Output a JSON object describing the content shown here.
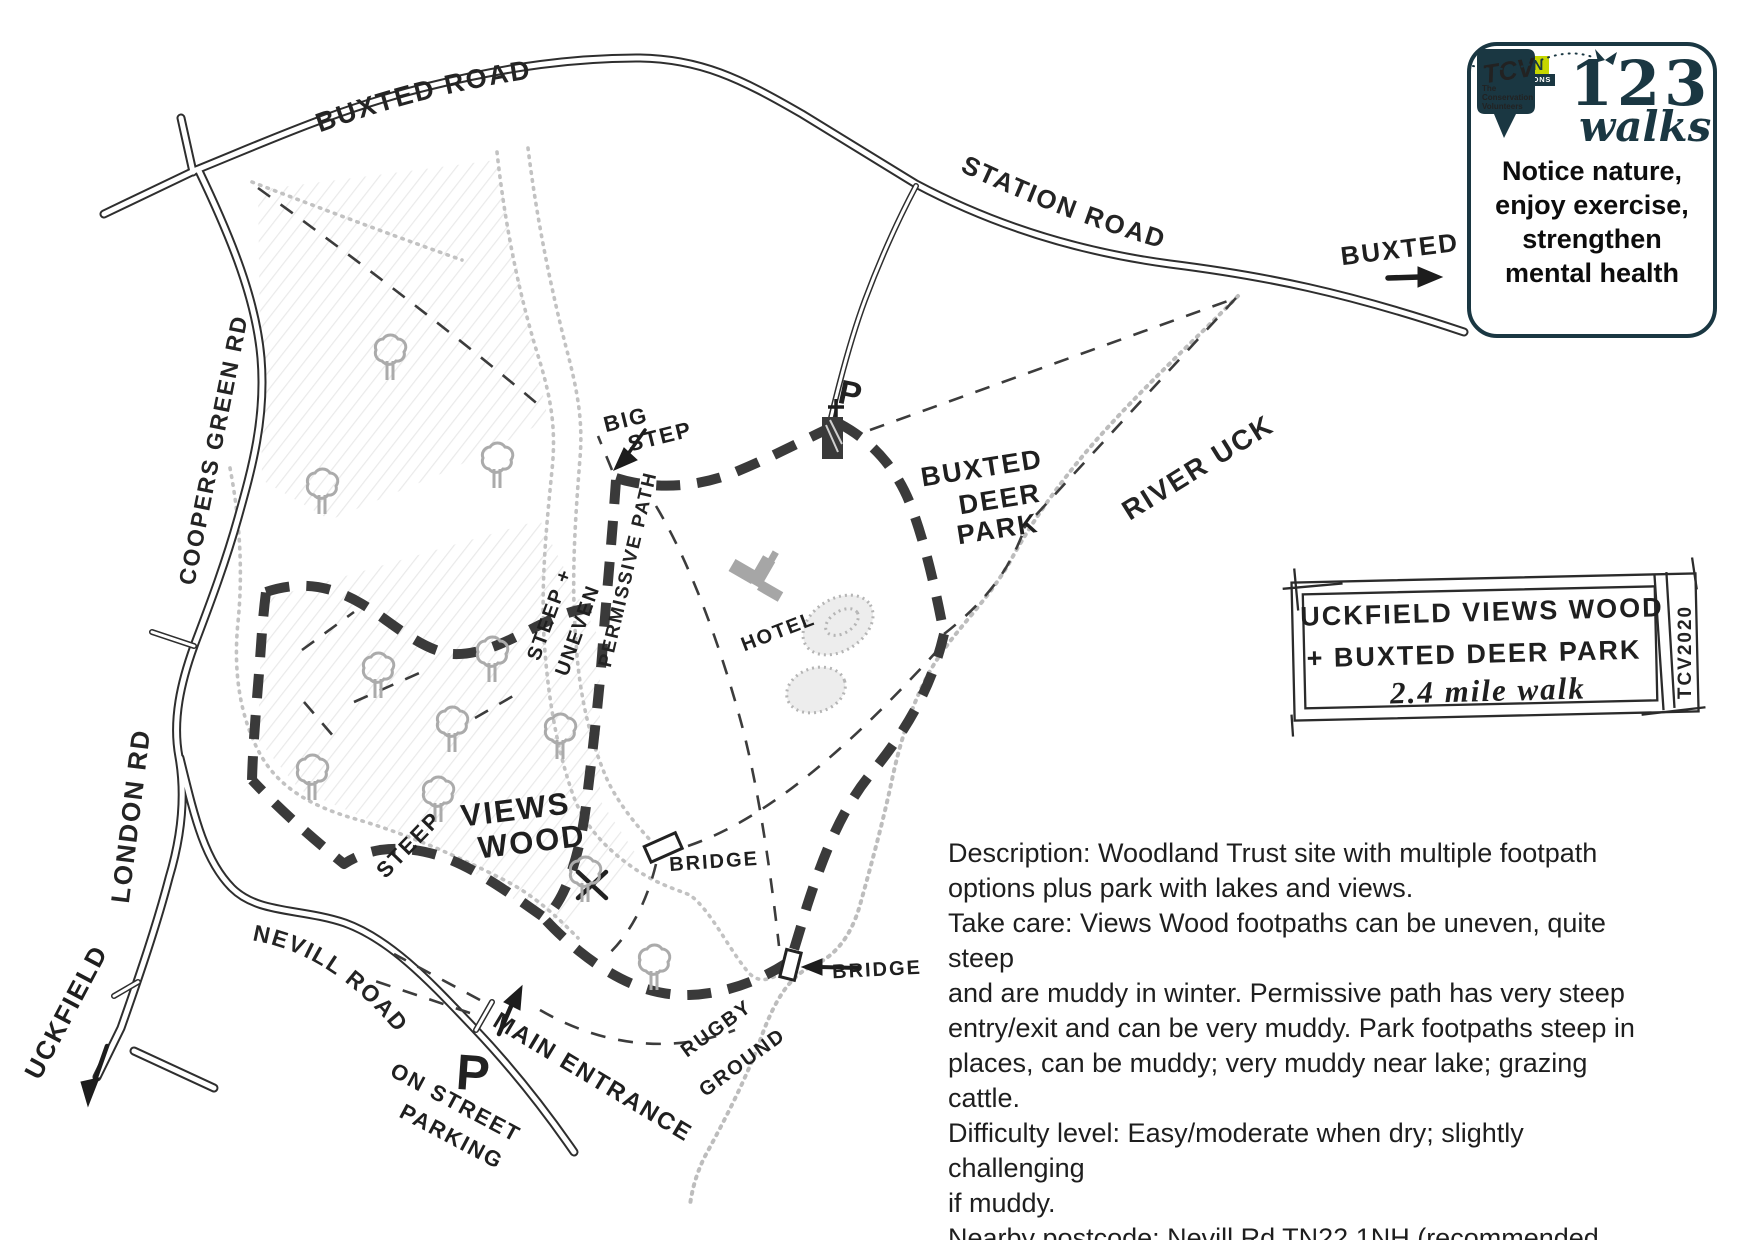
{
  "logo_box": {
    "tcv": "TCV",
    "tcv_sub1": "The",
    "tcv_sub2": "Conservation",
    "tcv_sub3": "Volunteers",
    "green_label": "GREEN",
    "connections_label": "CONNECTIONS",
    "big_123": "123",
    "walks": "walks",
    "tagline": "Notice nature,\nenjoy exercise,\nstrengthen\nmental health",
    "navy": "#1a3742",
    "lime": "#c6d600"
  },
  "title_box": {
    "line1": "UCKFIELD VIEWS WOOD",
    "line2": "+ BUXTED DEER PARK",
    "line3": "2.4 mile walk",
    "credit": "TCV2020"
  },
  "description": {
    "text": "Description: Woodland Trust site with multiple footpath\noptions plus park with lakes and views.\nTake care: Views Wood footpaths can be uneven, quite steep\nand are muddy in winter. Permissive path has very steep\nentry/exit and can be very muddy. Park footpaths steep in\nplaces, can be muddy; very muddy near lake; grazing cattle.\nDifficulty level: Easy/moderate when dry; slightly challenging\nif muddy.\nNearby postcode: Nevill Rd TN22 1NH (recommended\nWoodland Trust parking); St Margaret Church TN22 4AY"
  },
  "map": {
    "colors": {
      "route": "#3a3a3a",
      "water": "#bdbdbd",
      "ink": "#2e2e2e"
    },
    "roads": {
      "buxted_road": "BUXTED ROAD",
      "station_road": "STATION ROAD",
      "coopers_green_rd": "COOPERS GREEN RD",
      "london_rd": "LONDON RD",
      "nevill_road": "NEVILL ROAD"
    },
    "labels": {
      "uckfield": "UCKFIELD",
      "buxted_dest": "BUXTED",
      "river_uck": "RIVER UCK",
      "views": "VIEWS",
      "wood": "WOOD",
      "deer1": "BUXTED",
      "deer2": "DEER",
      "deer3": "PARK",
      "hotel": "HOTEL",
      "bridge1": "BRIDGE",
      "bridge2": "BRIDGE",
      "rugby1": "RUGBY",
      "rugby2": "GROUND",
      "steep": "STEEP",
      "steep_uneven1": "STEEP +",
      "steep_uneven2": "UNEVEN",
      "big_step1": "BIG",
      "big_step2": "STEP",
      "permissive_path": "PERMISSIVE PATH",
      "main_entrance": "MAIN ENTRANCE",
      "on_street1": "ON STREET",
      "on_street2": "PARKING",
      "parking_p_road": "P",
      "parking_p_church": "P"
    }
  }
}
